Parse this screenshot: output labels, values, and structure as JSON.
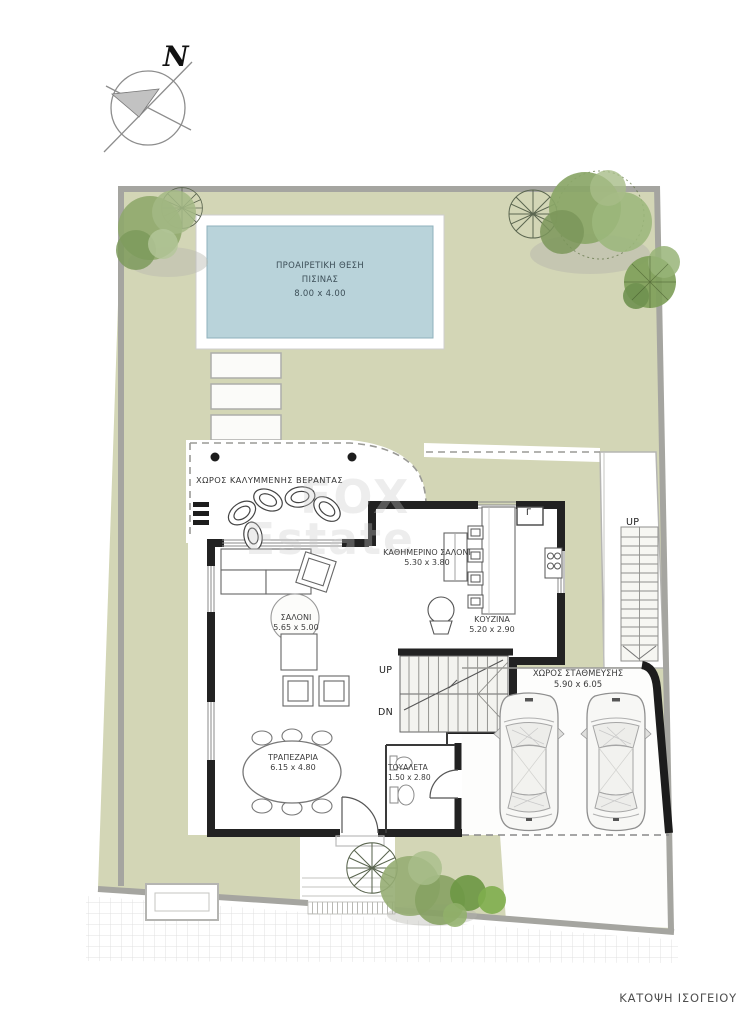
{
  "plan_title": "ΚΑΤΟΨΗ ΙΣΟΓΕΙΟΥ",
  "compass": {
    "north": "N"
  },
  "watermark": {
    "line1": "FOX",
    "line2": "Estate"
  },
  "pool": {
    "name_line1": "ΠΡΟΑΙΡΕΤΙΚΗ ΘΕΣΗ",
    "name_line2": "ΠΙΣΙΝΑΣ",
    "dims": "8.00 x 4.00"
  },
  "rooms": {
    "veranda": {
      "label": "ΧΩΡΟΣ ΚΑΛΥΜΜΕΝΗΣ ΒΕΡΑΝΤΑΣ"
    },
    "living": {
      "label": "ΣΑΛΟΝΙ",
      "dims": "5.65 x 5.00"
    },
    "family": {
      "label": "ΚΑΘΗΜΕΡΙΝΟ ΣΑΛΟΝΙ",
      "dims": "5.30 x 3.80"
    },
    "kitchen": {
      "label": "ΚΟΥΖΙΝΑ",
      "dims": "5.20 x 2.90"
    },
    "dining": {
      "label": "ΤΡΑΠΕΖΑΡΙΑ",
      "dims": "6.15 x 4.80"
    },
    "toilet": {
      "label": "ΤΟΥΑΛΕΤΑ",
      "dims": "1.50 x 2.80"
    },
    "parking": {
      "label": "ΧΩΡΟΣ ΣΤΑΘΜΕΥΣΗΣ",
      "dims": "5.90 x 6.05"
    }
  },
  "stairs": {
    "up": "UP",
    "down": "DN",
    "external_up": "UP"
  },
  "kitchen_appliance_label": "Γ",
  "colors": {
    "lawn": "#d3d6b6",
    "pool_water": "#b9d3da",
    "pool_frame": "#ffffff",
    "wall_black": "#222222",
    "boundary_gray": "#a5a5a0",
    "street_grid": "#dedede"
  }
}
